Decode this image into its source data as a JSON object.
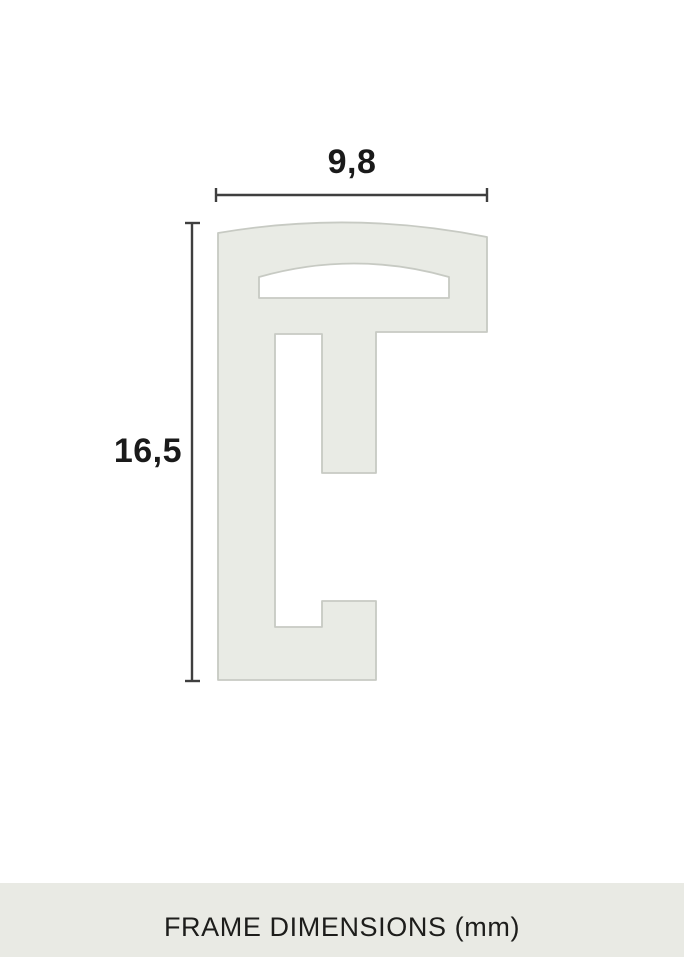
{
  "diagram": {
    "width_label": "9,8",
    "height_label": "16,5"
  },
  "caption": {
    "text": "FRAME DIMENSIONS (mm)"
  },
  "colors": {
    "background": "#ffffff",
    "profile_fill": "#e9ebe5",
    "profile_stroke": "#c7cac3",
    "dimension_line": "#3f3f3f",
    "label_text": "#1a1a1a",
    "caption_bg": "#e9eae4",
    "caption_text": "#1d1d1b"
  }
}
